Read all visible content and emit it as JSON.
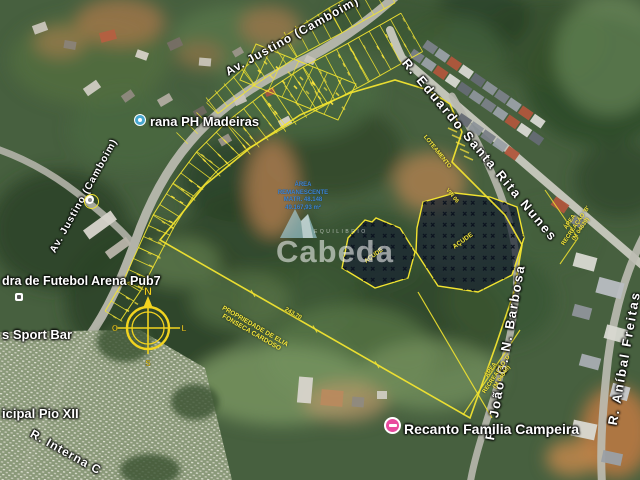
{
  "map": {
    "street_labels": {
      "av_justino": "Av. Justino (Camboim)",
      "r_eduardo": "R. Eduardo Santa Rita Nunes",
      "r_joao": "R. João G. N. Barbosa",
      "r_anibal": "R. Aníbal Freitas",
      "r_interna": "R. Interna C"
    },
    "place_labels": {
      "ph_madeiras": "rana PH Madeiras",
      "futebol": "dra de Futebol Arena Pub7",
      "sport_bar": "s Sport Bar",
      "pio_xii": "icipal Pio XII",
      "recanto": "Recanto Familia Campeira"
    },
    "survey_labels": {
      "propriedade_line1": "PROPRIEDADE DE ELIA",
      "propriedade_line2": "FONSECA CARDOSO",
      "acude": "AÇUDE",
      "recreacao_d": [
        "ÁREA",
        "RECREAÇÃO 'D'",
        "(M 04640)"
      ],
      "recreacao_b": [
        "ÁREA",
        "RECREAÇÃO 'B'",
        "(M 04639)"
      ],
      "loteamento": "LOTEAMENTO",
      "vin": "VIN 06",
      "dim_south": "243,70",
      "blue_note": [
        "ÁREA",
        "REMANESCENTE",
        "MATR. 48.148",
        "49.167,93 m²"
      ]
    },
    "compass": {
      "n": "N",
      "s": "S",
      "l": "L",
      "o": "O"
    },
    "watermark": {
      "brand": "Cabeda",
      "tagline": "EQUILIBRIO"
    },
    "colors": {
      "survey_yellow": "#f2e430",
      "label_white": "#ffffff",
      "pin_pink": "#e84a9e",
      "pin_blue": "#49a7cf",
      "note_blue": "#3b86d8"
    }
  }
}
